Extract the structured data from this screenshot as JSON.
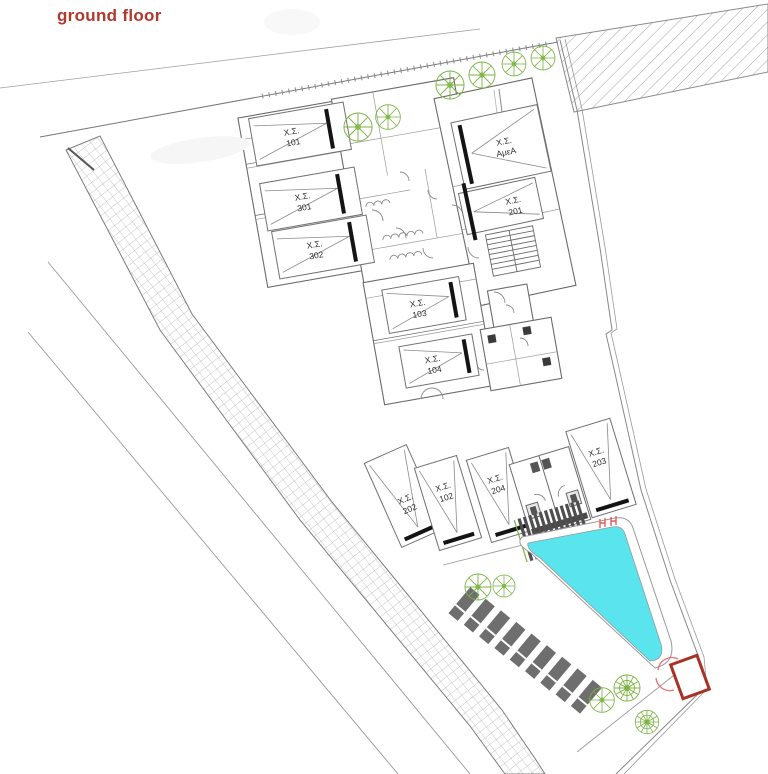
{
  "title": {
    "text": "ground floor"
  },
  "colors": {
    "title": "#b0382c",
    "pool_water": "#5ae4ee",
    "tree": "#7cb342",
    "gate": "#a93226",
    "gate_arc": "#e57373",
    "ladder": "#e05c5c",
    "building_line": "#6b6b6b",
    "parking_bar": "#141414",
    "lounger": "#6e6e6e",
    "hatch": "#9a9a9a"
  },
  "stalls": [
    {
      "label": "Χ.Σ.",
      "num": "101"
    },
    {
      "label": "Χ.Σ.",
      "num": "301"
    },
    {
      "label": "Χ.Σ.",
      "num": "302"
    },
    {
      "label": "Χ.Σ.",
      "num": "ΑμεΑ"
    },
    {
      "label": "Χ.Σ.",
      "num": "201"
    },
    {
      "label": "Χ.Σ.",
      "num": "103"
    },
    {
      "label": "Χ.Σ.",
      "num": "104"
    },
    {
      "label": "Χ.Σ.",
      "num": "202"
    },
    {
      "label": "Χ.Σ.",
      "num": "102"
    },
    {
      "label": "Χ.Σ.",
      "num": "204"
    },
    {
      "label": "Χ.Σ.",
      "num": "203"
    }
  ]
}
